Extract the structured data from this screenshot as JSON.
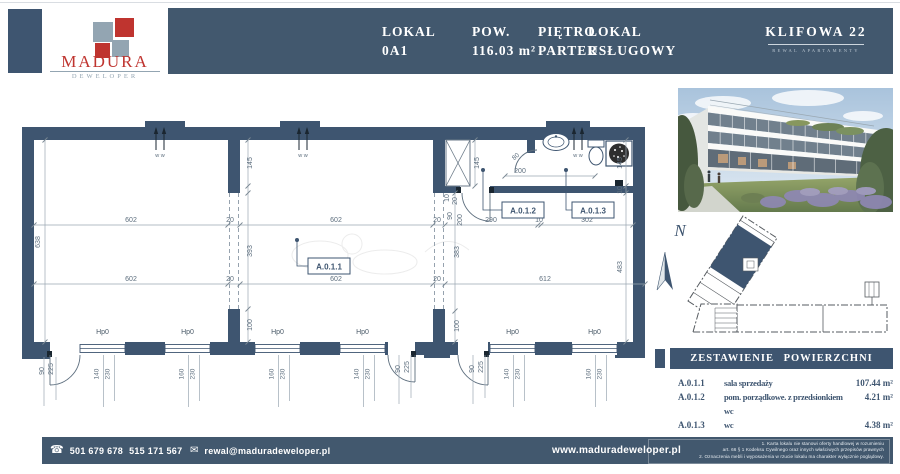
{
  "colors": {
    "navy": "#3e5570",
    "bar": "#42586e",
    "red": "#bf342f",
    "gray_blue": "#93a5b2",
    "dim_text": "#5d6e7e",
    "line": "#8b99a6"
  },
  "header": {
    "brand": {
      "name": "MADURA",
      "sub": "DEWELOPER"
    },
    "fields": [
      {
        "label": "LOKAL",
        "value": "0A1",
        "x": 214
      },
      {
        "label": "POW.",
        "value": "116.03 m²",
        "x": 304
      },
      {
        "label": "PIĘTRO",
        "value": "PARTER",
        "x": 370
      },
      {
        "label": "LOKAL",
        "value": "USŁUGOWY",
        "x": 420
      }
    ],
    "project": {
      "title": "KLIFOWA 22",
      "subtitle": "REWAL APARTAMENTY"
    }
  },
  "plan": {
    "sill_label": "Hp0",
    "vent_label": "w w",
    "vents": [
      {
        "x": 160
      },
      {
        "x": 303
      },
      {
        "x": 578
      }
    ],
    "windows": [
      {
        "x": 80,
        "w": 45,
        "d1": "140",
        "d2": "230"
      },
      {
        "x": 165,
        "w": 45,
        "d1": "160",
        "d2": "230"
      },
      {
        "x": 255,
        "w": 45,
        "d1": "160",
        "d2": "230"
      },
      {
        "x": 340,
        "w": 45,
        "d1": "140",
        "d2": "230"
      },
      {
        "x": 490,
        "w": 45,
        "d1": "140",
        "d2": "230"
      },
      {
        "x": 572,
        "w": 45,
        "d1": "160",
        "d2": "230"
      }
    ],
    "room_tags": [
      {
        "id": "A.0.1.1",
        "bx": 308,
        "by": 258,
        "dx": 297,
        "dy": 240
      },
      {
        "id": "A.0.1.2",
        "bx": 502,
        "by": 202,
        "dx": 483,
        "dy": 170
      },
      {
        "id": "A.0.1.3",
        "bx": 572,
        "by": 202,
        "dx": 566,
        "dy": 170
      }
    ],
    "dims_h": [
      {
        "t": "602",
        "x": 131,
        "y": 222
      },
      {
        "t": "20",
        "x": 230,
        "y": 222
      },
      {
        "t": "602",
        "x": 336,
        "y": 222
      },
      {
        "t": "20",
        "x": 437,
        "y": 222
      },
      {
        "t": "290",
        "x": 491,
        "y": 222
      },
      {
        "t": "10",
        "x": 539,
        "y": 222
      },
      {
        "t": "302",
        "x": 587,
        "y": 222
      },
      {
        "t": "602",
        "x": 131,
        "y": 281
      },
      {
        "t": "20",
        "x": 230,
        "y": 281
      },
      {
        "t": "602",
        "x": 336,
        "y": 281
      },
      {
        "t": "20",
        "x": 437,
        "y": 281
      },
      {
        "t": "612",
        "x": 545,
        "y": 281
      },
      {
        "t": "200",
        "x": 520,
        "y": 173
      }
    ],
    "dims_r": [
      {
        "t": "80",
        "x": 517,
        "y": 158,
        "r": -42
      }
    ],
    "dims_v": [
      {
        "t": "638",
        "x": 40,
        "y": 242
      },
      {
        "t": "145",
        "x": 252,
        "y": 163
      },
      {
        "t": "393",
        "x": 252,
        "y": 251
      },
      {
        "t": "100",
        "x": 252,
        "y": 325
      },
      {
        "t": "145",
        "x": 479,
        "y": 163
      },
      {
        "t": "383",
        "x": 459,
        "y": 252
      },
      {
        "t": "100",
        "x": 459,
        "y": 326
      },
      {
        "t": "145",
        "x": 622,
        "y": 163
      },
      {
        "t": "10",
        "x": 622,
        "y": 190
      },
      {
        "t": "483",
        "x": 622,
        "y": 267
      },
      {
        "t": "10",
        "x": 449,
        "y": 198
      },
      {
        "t": "20",
        "x": 457,
        "y": 201
      },
      {
        "t": "90",
        "x": 452,
        "y": 216
      },
      {
        "t": "200",
        "x": 462,
        "y": 220
      },
      {
        "t": "90",
        "x": 44,
        "y": 371
      },
      {
        "t": "225",
        "x": 53,
        "y": 369
      },
      {
        "t": "90",
        "x": 400,
        "y": 369
      },
      {
        "t": "225",
        "x": 409,
        "y": 367
      },
      {
        "t": "90",
        "x": 474,
        "y": 369
      },
      {
        "t": "225",
        "x": 483,
        "y": 367
      }
    ]
  },
  "sidebar": {
    "north_label": "N",
    "table": {
      "title": "ZESTAWIENIE POWIERZCHNI",
      "rows": [
        {
          "id": "A.0.1.1",
          "name": "sala sprzedaży",
          "area": "107.44 m²"
        },
        {
          "id": "A.0.1.2",
          "name": "pom. porządkowe. z przedsionkiem wc",
          "area": "4.21 m²"
        },
        {
          "id": "A.0.1.3",
          "name": "wc",
          "area": "4.38 m²"
        }
      ]
    }
  },
  "footer": {
    "phone1": "501 679 678",
    "phone2": "515 171 567",
    "email": "rewal@maduradeweloper.pl",
    "website": "www.maduradeweloper.pl",
    "legal": [
      "1. Karta lokalu nie stanowi oferty handlowej w rozumieniu",
      "art. 66 § 1 Kodeksu Cywilnego oraz innych właściwych przepisów prawnych",
      "2. Oznaczenia mebli i wyposażenia w rzucie lokalu ma charakter wyłącznie poglądowy."
    ]
  }
}
